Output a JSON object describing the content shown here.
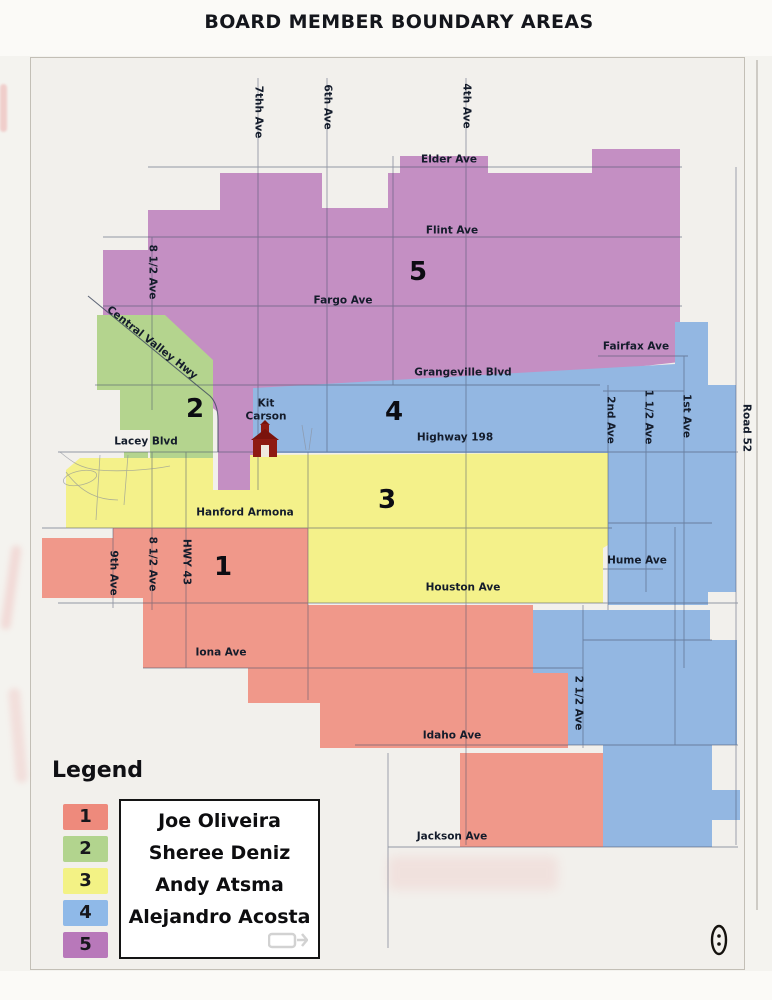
{
  "title": "BOARD MEMBER BOUNDARY AREAS",
  "colors": {
    "region1_salmon": "#f0988a",
    "region2_green": "#b4d48e",
    "region3_yellow": "#f4f18a",
    "region4_blue": "#93b7e2",
    "region5_purple": "#c48fc3",
    "map_background": "#f2f0ec"
  },
  "map": {
    "region_labels": [
      {
        "number": "1",
        "x": 223,
        "y": 567
      },
      {
        "number": "2",
        "x": 195,
        "y": 409
      },
      {
        "number": "3",
        "x": 387,
        "y": 500
      },
      {
        "number": "4",
        "x": 394,
        "y": 412
      },
      {
        "number": "5",
        "x": 418,
        "y": 272
      }
    ],
    "street_labels": [
      {
        "text": "7thh Ave",
        "x": 258,
        "y": 112,
        "rot": 90
      },
      {
        "text": "6th Ave",
        "x": 327,
        "y": 107,
        "rot": 90
      },
      {
        "text": "4th Ave",
        "x": 466,
        "y": 106,
        "rot": 90
      },
      {
        "text": "Elder Ave",
        "x": 449,
        "y": 160
      },
      {
        "text": "Flint Ave",
        "x": 452,
        "y": 231
      },
      {
        "text": "8 1/2 Ave",
        "x": 152,
        "y": 272,
        "rot": 90
      },
      {
        "text": "Fargo Ave",
        "x": 343,
        "y": 301
      },
      {
        "text": "Central Valley Hwy",
        "x": 152,
        "y": 343,
        "rot": 38
      },
      {
        "text": "Fairfax Ave",
        "x": 636,
        "y": 347
      },
      {
        "text": "Grangeville Blvd",
        "x": 463,
        "y": 373
      },
      {
        "text": "Lacey Blvd",
        "x": 146,
        "y": 442
      },
      {
        "text": "Kit Carson",
        "x": 266,
        "y": 410,
        "width": 54
      },
      {
        "text": "Highway 198",
        "x": 455,
        "y": 438
      },
      {
        "text": "2nd Ave",
        "x": 610,
        "y": 420,
        "rot": 90
      },
      {
        "text": "1 1/2 Ave",
        "x": 648,
        "y": 417,
        "rot": 90
      },
      {
        "text": "1st Ave",
        "x": 686,
        "y": 416,
        "rot": 90
      },
      {
        "text": "Road 52",
        "x": 746,
        "y": 428,
        "rot": 90
      },
      {
        "text": "Hanford Armona",
        "x": 245,
        "y": 513
      },
      {
        "text": "9th Ave",
        "x": 113,
        "y": 573,
        "rot": 90
      },
      {
        "text": "8 1/2 Ave",
        "x": 152,
        "y": 564,
        "rot": 90
      },
      {
        "text": "HWY 43",
        "x": 186,
        "y": 562,
        "rot": 90
      },
      {
        "text": "Hume Ave",
        "x": 637,
        "y": 561
      },
      {
        "text": "Houston Ave",
        "x": 463,
        "y": 588
      },
      {
        "text": "Iona Ave",
        "x": 221,
        "y": 653
      },
      {
        "text": "2 1/2 Ave",
        "x": 578,
        "y": 703,
        "rot": 90
      },
      {
        "text": "Idaho Ave",
        "x": 452,
        "y": 736
      },
      {
        "text": "Jackson Ave",
        "x": 452,
        "y": 837
      }
    ],
    "poi_icons": [
      "schoolhouse-icon",
      "oval-stamp-icon"
    ]
  },
  "legend": {
    "title": "Legend",
    "items": [
      {
        "number": "1",
        "name": "Joe Oliveira",
        "color": "#ee8a7c"
      },
      {
        "number": "2",
        "name": "Sheree Deniz",
        "color": "#b2d48e"
      },
      {
        "number": "3",
        "name": "Andy Atsma",
        "color": "#f3f285"
      },
      {
        "number": "4",
        "name": "Alejandro Acosta",
        "color": "#8fb9e8"
      },
      {
        "number": "5",
        "name": "",
        "color": "#b878ba"
      }
    ]
  }
}
